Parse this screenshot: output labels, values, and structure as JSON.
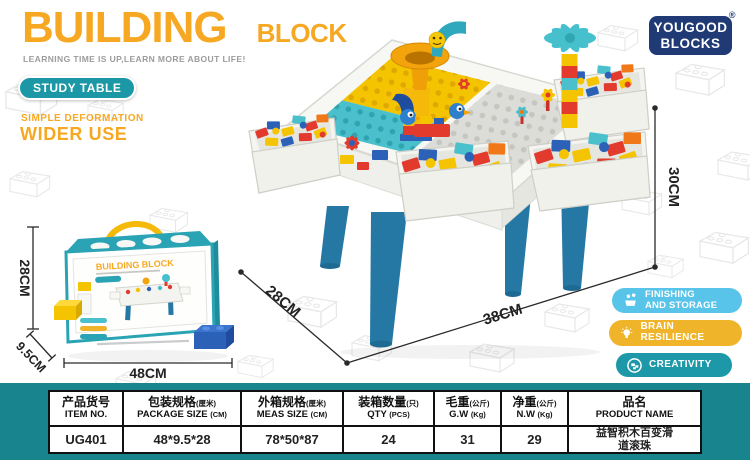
{
  "page": {
    "background": "#ffffff",
    "band_color": "#17848E"
  },
  "header": {
    "title_main": "BUILDING",
    "title_sub": "BLOCK",
    "tagline": "LEARNING TIME IS UP,LEARN MORE ABOUT LIFE!",
    "study_badge": "STUDY TABLE",
    "feature_line1": "SIMPLE DEFORMATION",
    "feature_line2": "WIDER USE"
  },
  "brand": {
    "line1": "YOUGOOD",
    "line2": "BLOCKS",
    "registered": "®",
    "color": "#1F3A74"
  },
  "feature_badges": [
    {
      "label_top": "FINISHING",
      "label_bottom": "AND STORAGE",
      "color": "#58C4E9",
      "icon": "storage-bin-icon"
    },
    {
      "label": "BRAIN RESILIENCE",
      "color": "#F0B42B",
      "icon": "lightbulb-icon"
    },
    {
      "label": "CREATIVITY",
      "color": "#1D98A8",
      "icon": "hand-blocks-icon"
    }
  ],
  "packaging_box": {
    "title": "BUILDING BLOCK"
  },
  "dimensions": {
    "box_height": "28CM",
    "box_depth": "9.5CM",
    "box_width": "48CM",
    "table_depth": "28CM",
    "table_width": "38CM",
    "table_height": "30CM"
  },
  "spec_table": {
    "columns": [
      {
        "cn": "产品货号",
        "cn_unit": "",
        "en": "ITEM NO.",
        "en_unit": ""
      },
      {
        "cn": "包装规格",
        "cn_unit": "(厘米)",
        "en": "PACKAGE SIZE",
        "en_unit": "(CM)"
      },
      {
        "cn": "外箱规格",
        "cn_unit": "(厘米)",
        "en": "MEAS SIZE",
        "en_unit": "(CM)"
      },
      {
        "cn": "装箱数量",
        "cn_unit": "(只)",
        "en": "QTY",
        "en_unit": "(PCS)"
      },
      {
        "cn": "毛重",
        "cn_unit": "(公斤)",
        "en": "G.W",
        "en_unit": "(Kg)"
      },
      {
        "cn": "净重",
        "cn_unit": "(公斤)",
        "en": "N.W",
        "en_unit": "(Kg)"
      },
      {
        "cn": "品名",
        "cn_unit": "",
        "en": "PRODUCT NAME",
        "en_unit": ""
      }
    ],
    "row": {
      "item_no": "UG401",
      "package_size": "48*9.5*28",
      "meas_size": "78*50*87",
      "qty": "24",
      "gross_weight": "31",
      "net_weight": "29",
      "product_name": "益智积木百变滑道滚珠"
    }
  },
  "colors": {
    "accent_orange": "#F7A823",
    "teal_badge": "#1B97A5",
    "navy": "#1F3A74",
    "band_teal": "#17848E",
    "leg_blue": "#2478A3",
    "plate_yellow": "#F5C400",
    "plate_teal": "#49C0CB",
    "plate_gray": "#DCDCD8"
  }
}
